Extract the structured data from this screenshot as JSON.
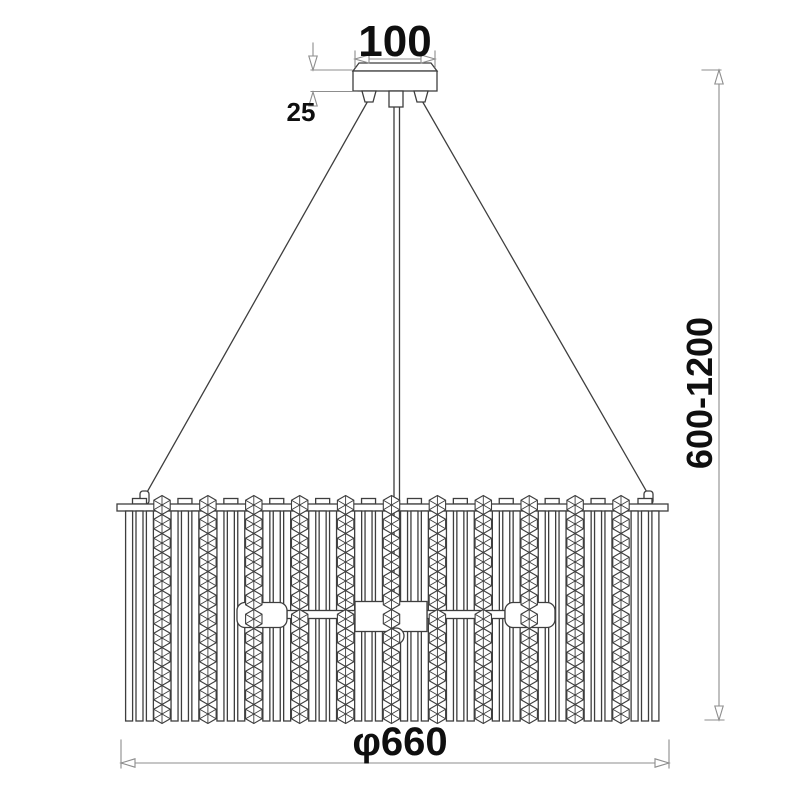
{
  "drawing": {
    "type": "technical-dimension-drawing",
    "subject": "crystal pendant chandelier"
  },
  "dimensions": {
    "canopy_width": "100",
    "canopy_height": "25",
    "suspension_height_range": "600-1200",
    "diameter": "φ660"
  },
  "colors": {
    "background": "#ffffff",
    "drawing_line": "#3e3e3e",
    "dimension_line": "#8d8d8d",
    "label_text": "#0f0f0f"
  }
}
